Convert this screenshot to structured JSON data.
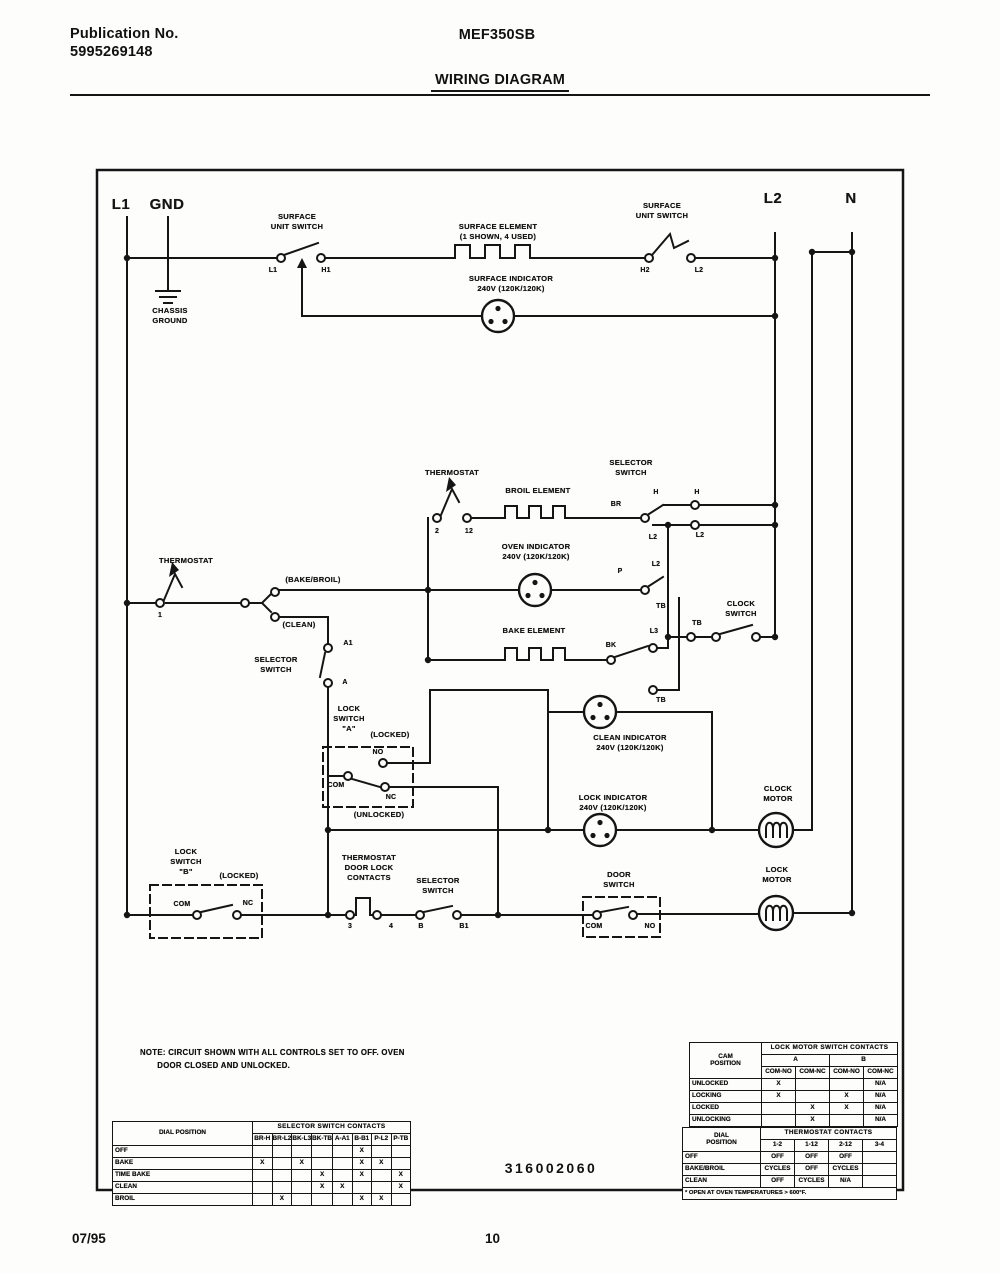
{
  "header": {
    "publication_label": "Publication No.",
    "publication_number": "5995269148",
    "model": "MEF350SB",
    "title": "WIRING DIAGRAM"
  },
  "diagram": {
    "labels": {
      "l1": "L1",
      "gnd": "GND",
      "l2": "L2",
      "n": "N",
      "chassis_ground": "CHASSIS\nGROUND",
      "surface_unit_switch_left": "SURFACE\nUNIT SWITCH",
      "sw1_l1": "L1",
      "sw1_h1": "H1",
      "surface_element": "SURFACE ELEMENT\n(1 SHOWN, 4 USED)",
      "surface_indicator": "SURFACE INDICATOR\n240V (120K/120K)",
      "surface_unit_switch_right": "SURFACE\nUNIT SWITCH",
      "sw2_h2": "H2",
      "sw2_l2": "L2",
      "thermostat_upper": "THERMOSTAT",
      "t2": "2",
      "t12": "12",
      "broil_element": "BROIL ELEMENT",
      "selector_switch_upper": "SELECTOR\nSWITCH",
      "br": "BR",
      "h_a": "H",
      "h_b": "H",
      "l2_a": "L2",
      "l2_b": "L2",
      "l2_c": "L2",
      "p": "P",
      "tb1": "TB",
      "l3": "L3",
      "bk": "BK",
      "tb2": "TB",
      "tb3": "TB",
      "oven_indicator": "OVEN INDICATOR\n240V (120K/120K)",
      "bake_element": "BAKE ELEMENT",
      "clock_switch": "CLOCK\nSWITCH",
      "thermostat_left": "THERMOSTAT",
      "t1": "1",
      "bake_broil": "(BAKE/BROIL)",
      "clean": "(CLEAN)",
      "a1": "A1",
      "a": "A",
      "selector_switch_left": "SELECTOR\nSWITCH",
      "lock_switch_a": "LOCK\nSWITCH\n\"A\"",
      "locked_a": "(LOCKED)",
      "no_a": "NO",
      "com_a": "COM",
      "nc_a": "NC",
      "unlocked_a": "(UNLOCKED)",
      "clean_indicator": "CLEAN INDICATOR\n240V (120K/120K)",
      "lock_indicator": "LOCK INDICATOR\n240V (120K/120K)",
      "clock_motor": "CLOCK\nMOTOR",
      "lock_switch_b": "LOCK\nSWITCH\n\"B\"",
      "locked_b": "(LOCKED)",
      "com_b": "COM",
      "nc_b": "NC",
      "thermostat_door_lock": "THERMOSTAT\nDOOR LOCK\nCONTACTS",
      "t3": "3",
      "t4": "4",
      "selector_switch_bottom": "SELECTOR\nSWITCH",
      "b": "B",
      "b1": "B1",
      "door_switch": "DOOR\nSWITCH",
      "com_d": "COM",
      "no_d": "NO",
      "lock_motor": "LOCK\nMOTOR"
    },
    "note": "NOTE: CIRCUIT SHOWN WITH ALL CONTROLS SET TO OFF. OVEN\n       DOOR CLOSED AND UNLOCKED.",
    "part_number": "316002060"
  },
  "tables": {
    "selector": {
      "title": "SELECTOR SWITCH CONTACTS",
      "corner": "DIAL POSITION",
      "columns": [
        "BR-H",
        "BR-L2",
        "BK-L3",
        "BK-TB",
        "A-A1",
        "B-B1",
        "P-L2",
        "P-TB"
      ],
      "rows": [
        {
          "label": "OFF",
          "cells": [
            "",
            "",
            "",
            "",
            "",
            "X",
            "",
            ""
          ]
        },
        {
          "label": "BAKE",
          "cells": [
            "X",
            "",
            "X",
            "",
            "",
            "X",
            "X",
            ""
          ]
        },
        {
          "label": "TIME BAKE",
          "cells": [
            "",
            "",
            "",
            "X",
            "",
            "X",
            "",
            "X"
          ]
        },
        {
          "label": "CLEAN",
          "cells": [
            "",
            "",
            "",
            "X",
            "X",
            "",
            "",
            "X"
          ]
        },
        {
          "label": "BROIL",
          "cells": [
            "",
            "X",
            "",
            "",
            "",
            "X",
            "X",
            ""
          ]
        }
      ]
    },
    "lock_motor": {
      "title": "LOCK MOTOR SWITCH CONTACTS",
      "corner": "CAM\nPOSITION",
      "groups": [
        "A",
        "B"
      ],
      "columns": [
        "COM-NO",
        "COM-NC",
        "COM-NO",
        "COM-NC"
      ],
      "rows": [
        {
          "label": "UNLOCKED",
          "cells": [
            "X",
            "",
            "",
            "N/A"
          ]
        },
        {
          "label": "LOCKING",
          "cells": [
            "X",
            "",
            "X",
            "N/A"
          ]
        },
        {
          "label": "LOCKED",
          "cells": [
            "",
            "X",
            "X",
            "N/A"
          ]
        },
        {
          "label": "UNLOCKING",
          "cells": [
            "",
            "X",
            "",
            "N/A"
          ]
        }
      ]
    },
    "thermostat": {
      "title": "THERMOSTAT CONTACTS",
      "corner": "DIAL\nPOSITION",
      "columns": [
        "1-2",
        "1-12",
        "2-12",
        "3-4"
      ],
      "rows": [
        {
          "label": "OFF",
          "cells": [
            "OFF",
            "OFF",
            "OFF",
            ""
          ]
        },
        {
          "label": "BAKE/BROIL",
          "cells": [
            "CYCLES",
            "OFF",
            "CYCLES",
            ""
          ]
        },
        {
          "label": "CLEAN",
          "cells": [
            "OFF",
            "CYCLES",
            "N/A",
            ""
          ]
        }
      ],
      "footnote": "* OPEN AT OVEN TEMPERATURES > 600°F."
    }
  },
  "footer": {
    "date": "07/95",
    "page": "10"
  }
}
